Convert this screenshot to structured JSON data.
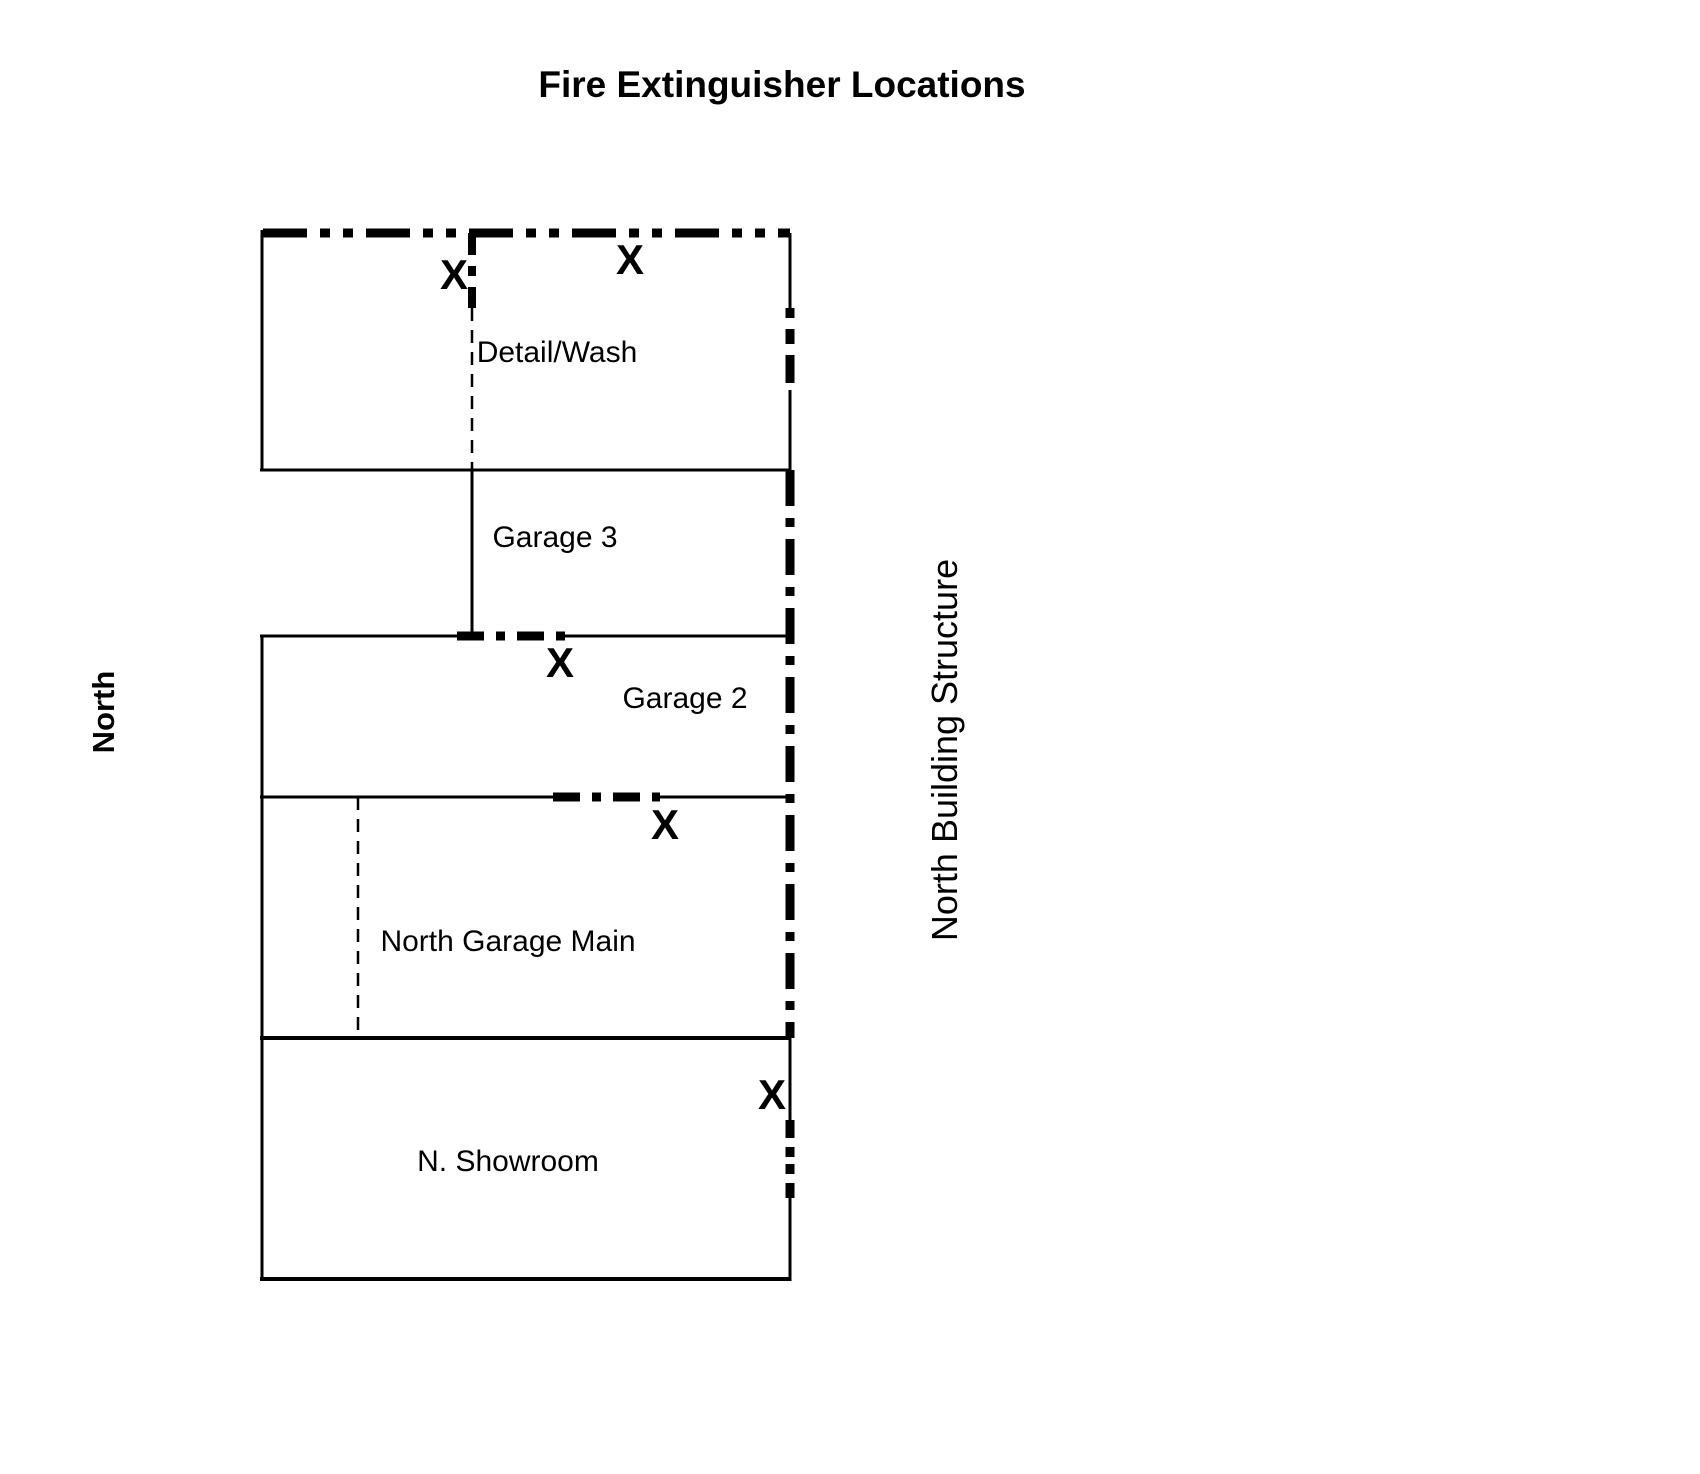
{
  "page": {
    "title": "Fire Extinguisher Locations",
    "title_color": "#ee1b23",
    "background_color": "#ffffff",
    "line_color": "#000000"
  },
  "orientation": {
    "compass_label": "North"
  },
  "building": {
    "structure_label": "North Building Structure",
    "rooms": [
      {
        "label": "Detail/Wash"
      },
      {
        "label": "Garage 3"
      },
      {
        "label": "Garage 2"
      },
      {
        "label": "North Garage Main"
      },
      {
        "label": "N. Showroom"
      }
    ]
  },
  "extinguishers": {
    "marker": "X",
    "marker_color": "#e8192d",
    "count": 5,
    "locations": [
      {
        "room": "Detail/Wash west partition",
        "marker": "X"
      },
      {
        "room": "Detail/Wash",
        "marker": "X"
      },
      {
        "room": "Garage 2",
        "marker": "X"
      },
      {
        "room": "North Garage Main",
        "marker": "X"
      },
      {
        "room": "N. Showroom",
        "marker": "X"
      }
    ]
  }
}
